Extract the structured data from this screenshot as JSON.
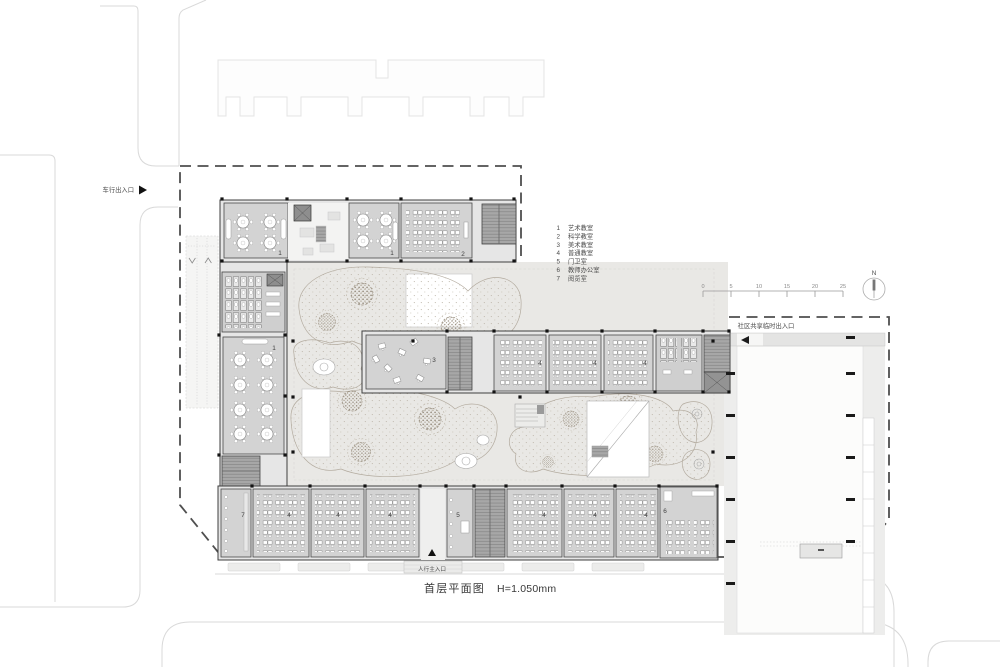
{
  "caption": {
    "name": "首层平面图",
    "height": "H=1.050mm"
  },
  "labels": {
    "vehicle_entrance": "车行出入口",
    "pedestrian_entrance": "人行主入口",
    "community_entrance": "社区共享临时出入口",
    "north": "N"
  },
  "legend": [
    {
      "num": "1",
      "name": "艺术教室"
    },
    {
      "num": "2",
      "name": "科学教室"
    },
    {
      "num": "3",
      "name": "美术教室"
    },
    {
      "num": "4",
      "name": "普通教室"
    },
    {
      "num": "5",
      "name": "门卫室"
    },
    {
      "num": "6",
      "name": "教师办公室"
    },
    {
      "num": "7",
      "name": "阅览室"
    }
  ],
  "scale_ticks": [
    "0",
    "5",
    "10",
    "15",
    "20",
    "25"
  ],
  "room_numbers": [
    "1",
    "1",
    "2",
    "1",
    "3",
    "4",
    "4",
    "4",
    "7",
    "4",
    "4",
    "4",
    "5",
    "4",
    "4",
    "4",
    "6"
  ]
}
